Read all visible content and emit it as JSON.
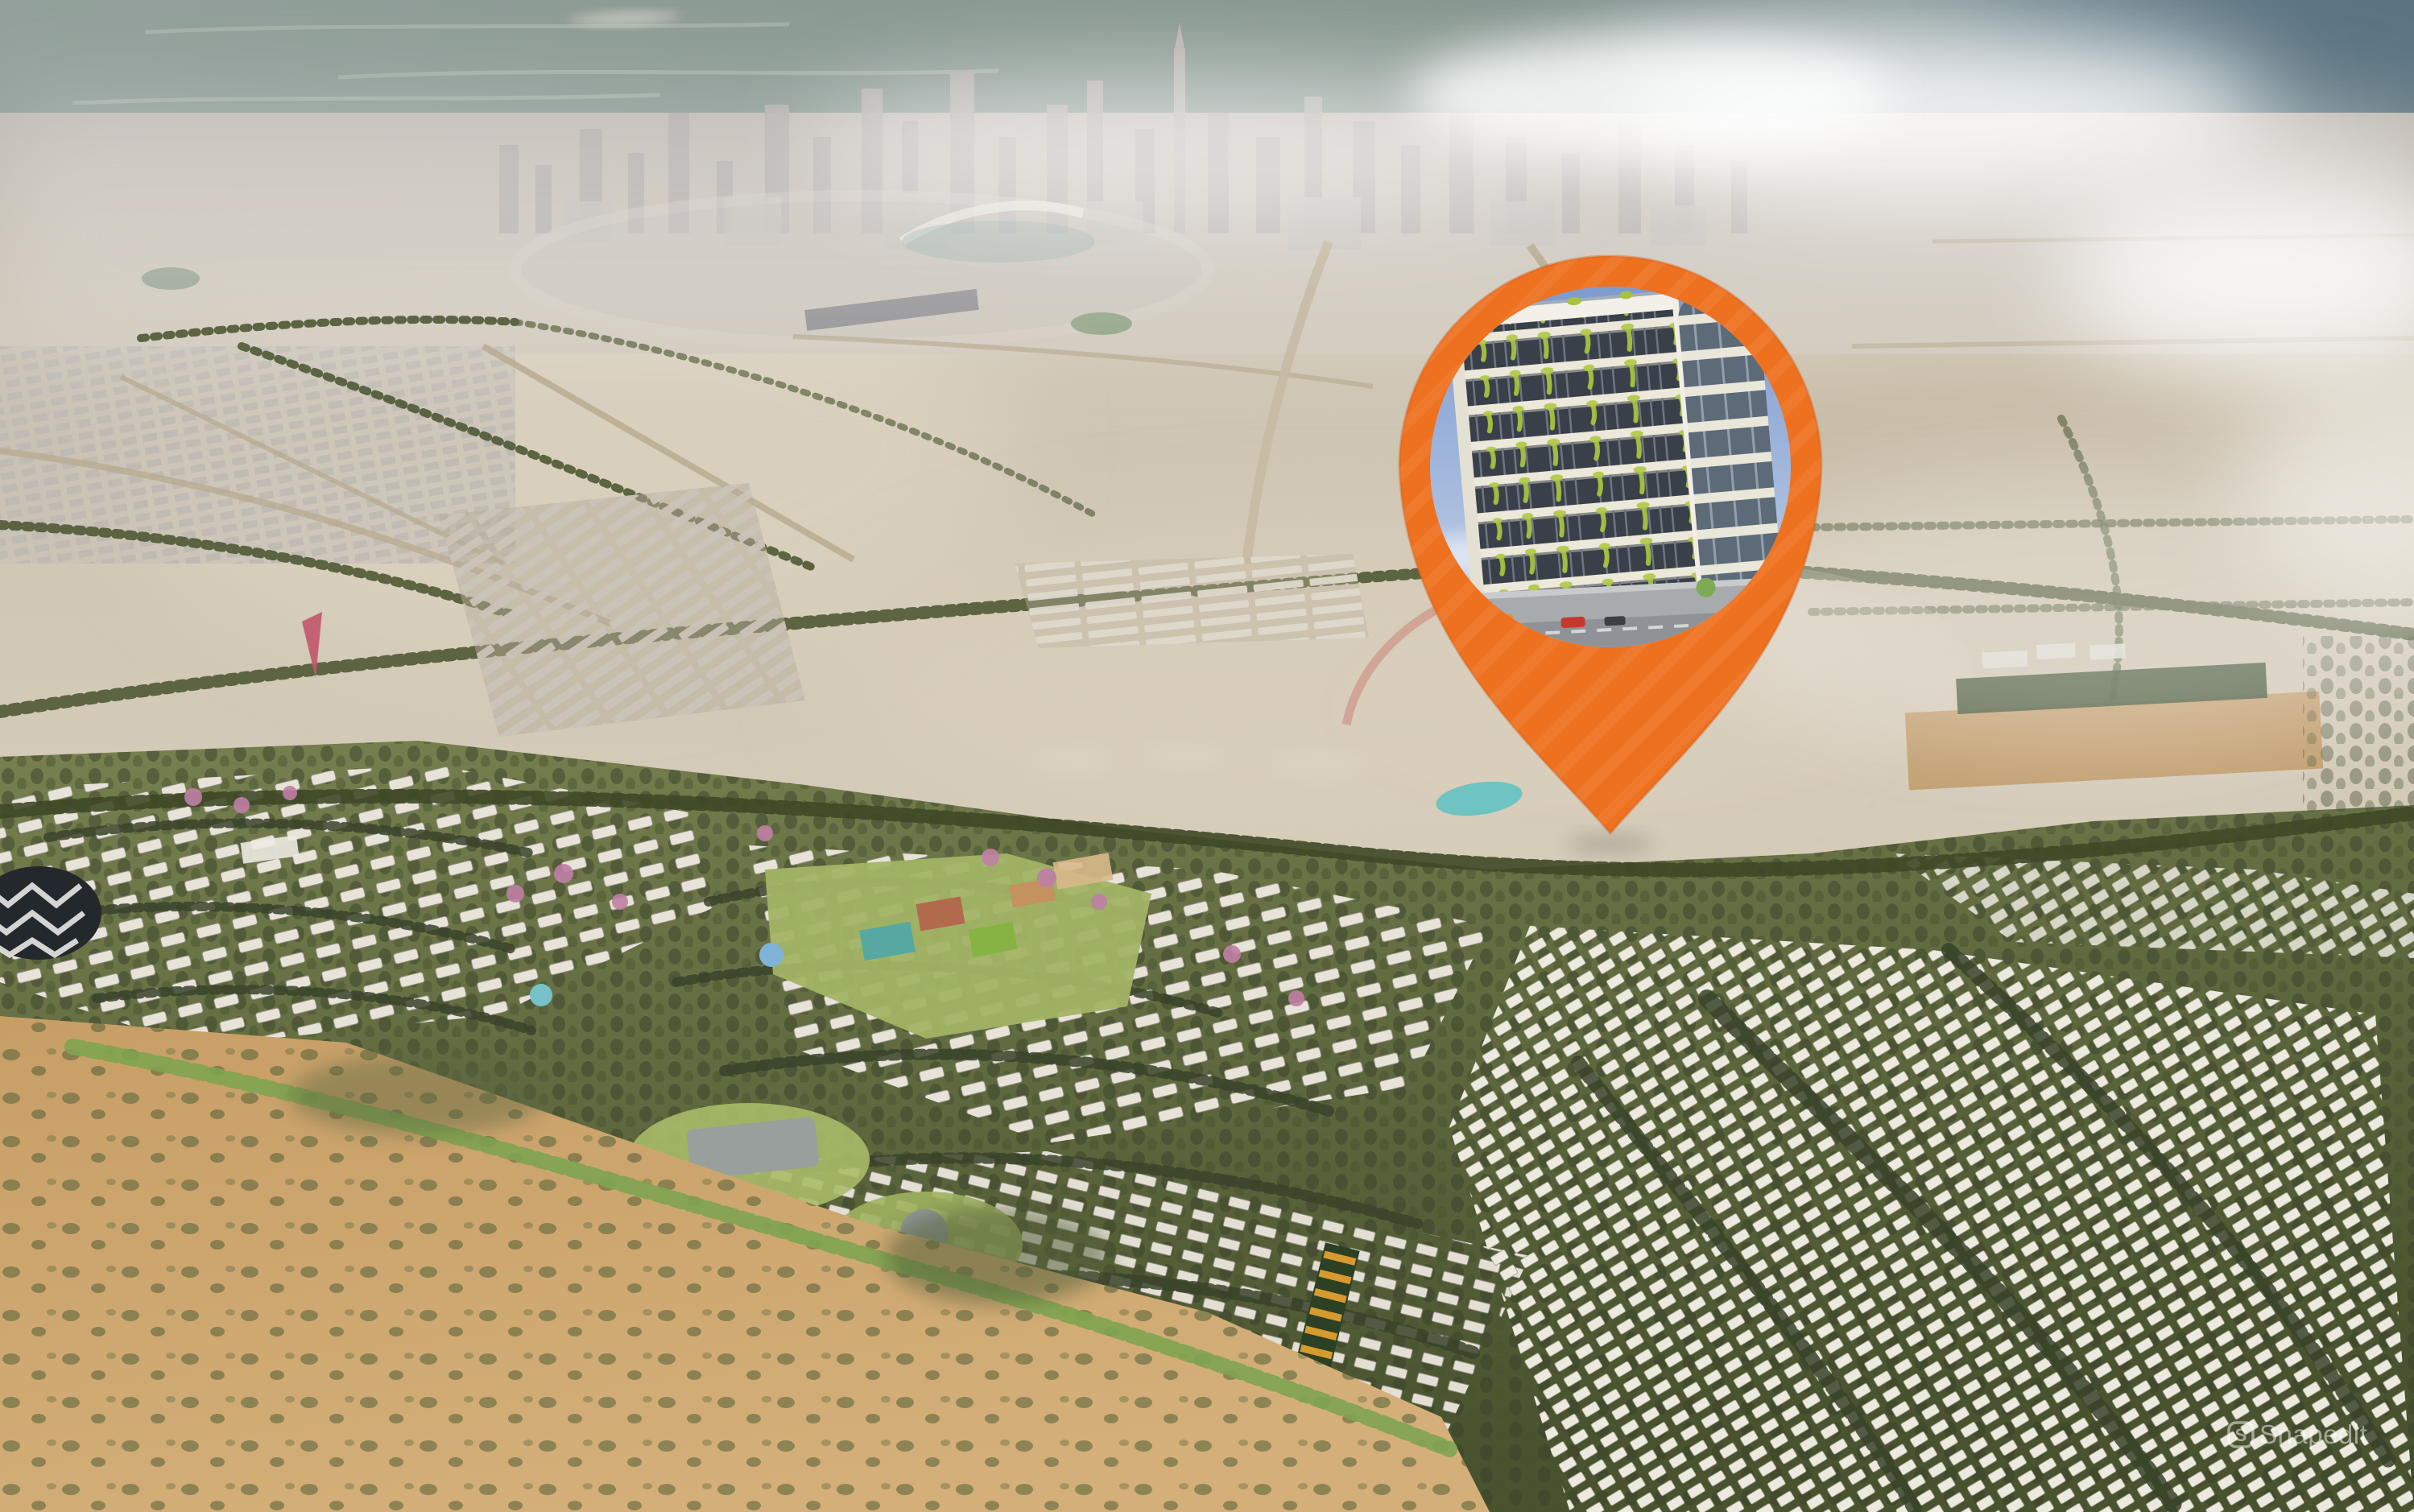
{
  "scene": {
    "type": "aerial-masterplan-render",
    "description": "Aerial 3D render of a desert master-planned community with a distant hazy city skyline and an orange location pin highlighting a residential building",
    "palette": {
      "water": "#8C9B96",
      "water_dark": "#5C7480",
      "city_haze": "#C7C2BC",
      "city_tower": "#B2ADAA",
      "desert": "#CFC6B4",
      "desert_light": "#DDD4C2",
      "sand": "#C8A26C",
      "foliage_dark": "#424C2B",
      "foliage": "#6E7747",
      "lawn": "#A2B465",
      "house_white": "#E9E5DA",
      "pink_trees": "#C07FA5",
      "pond_teal": "#6FC3C0"
    }
  },
  "pin": {
    "kind": "map-location-pin",
    "color": "#EE7120",
    "edge": "#D2601B",
    "photo": {
      "subject": "mid-rise residential building with cascading balcony plants",
      "sky_top": "#7D9ACD",
      "sky_bottom": "#C6D4EA",
      "facade": "#ECE8DA",
      "glass": "#394049",
      "glass_curved": "#5D6A78",
      "plants": "#A6C23F",
      "street": "#8F9296",
      "floors": 8
    }
  },
  "watermark": {
    "logo_icon": "snapedit-logo-icon",
    "logo_letter": "S",
    "label": "Snapedit",
    "color": "#FFFFFF"
  }
}
